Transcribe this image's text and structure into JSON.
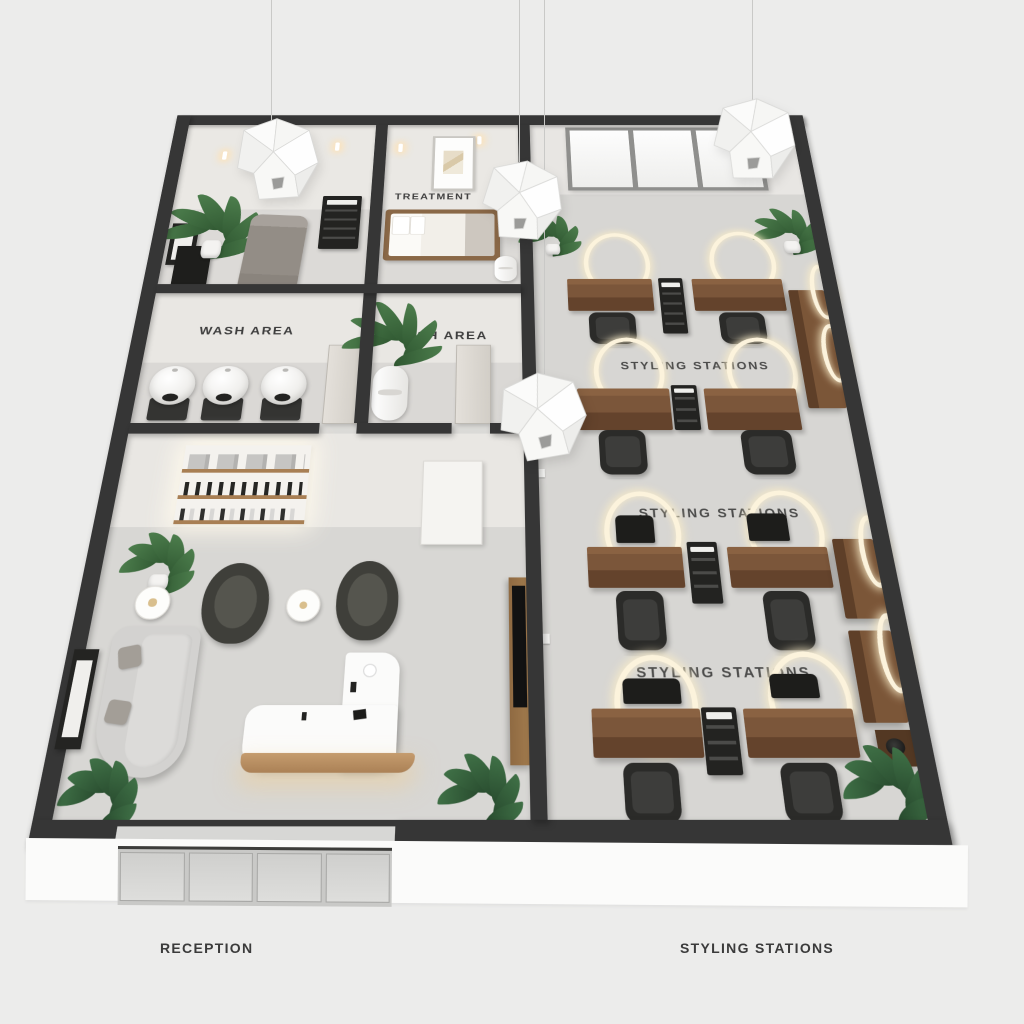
{
  "labels": {
    "treatment": "TREATMENT",
    "wash_left": "WASH AREA",
    "wash_right": "WASH AREA",
    "styling_floor_1": "STYLING STATIONS",
    "styling_floor_2": "STYLING STATIONS",
    "styling_floor_3": "STYLING STATIONS"
  },
  "captions": {
    "reception": "RECEPTION",
    "styling_stations": "STYLING STATIONS"
  },
  "rooms": [
    {
      "id": "treatment-room-1",
      "wall_label": "",
      "items": [
        "pendant light",
        "potted plant",
        "massage bed",
        "service trolley",
        "storage cabinet",
        "leaning frame",
        "wall sconce"
      ]
    },
    {
      "id": "treatment-room-2",
      "wall_label": "TREATMENT",
      "items": [
        "framed artwork",
        "treatment bed",
        "side stool",
        "wall sconces",
        "pendant light"
      ]
    },
    {
      "id": "wash-area-left",
      "wall_label": "WASH AREA",
      "items": [
        "backwash basin",
        "backwash basin",
        "backwash basin",
        "door"
      ]
    },
    {
      "id": "wash-area-right",
      "wall_label": "WASH AREA",
      "items": [
        "potted plant",
        "towel cabinet",
        "door"
      ]
    },
    {
      "id": "reception",
      "caption": "RECEPTION",
      "items": [
        "backlit retail shelving",
        "lounge armchair",
        "lounge armchair",
        "gold side table",
        "gold side table",
        "curved sofa",
        "curved reception desk",
        "display unit",
        "potted plants",
        "glass entry door",
        "wall frame"
      ]
    },
    {
      "id": "styling-area",
      "caption": "STYLING STATIONS",
      "items": [
        "styling desks",
        "styling chairs",
        "halo ring lights",
        "service trolleys",
        "wall consoles",
        "window wall",
        "potted plants",
        "accessory table"
      ]
    }
  ],
  "counts": {
    "styling_desks": 8,
    "styling_chairs": 8,
    "floor_ring_lights": 8,
    "wall_ring_lights": 4,
    "wash_basins": 3,
    "pendant_lights": 4,
    "treatment_beds": 2,
    "lounge_armchairs": 2,
    "service_trolleys": 5,
    "window_panes": 3,
    "entry_glass_panels": 4
  },
  "colors": {
    "background": "#ececeb",
    "walls": "#363636",
    "floor": "#d6d5d2",
    "wall_face": "#e9e7e3",
    "wood_dark": "#7b563a",
    "wood_light": "#bb9368",
    "chair_black": "#2b2b29",
    "sofa_gray": "#d3d2d0",
    "plant_green": "#3f7046",
    "ring_glow": "#fcf3dc",
    "warm_glow": "#f5e3c0"
  }
}
